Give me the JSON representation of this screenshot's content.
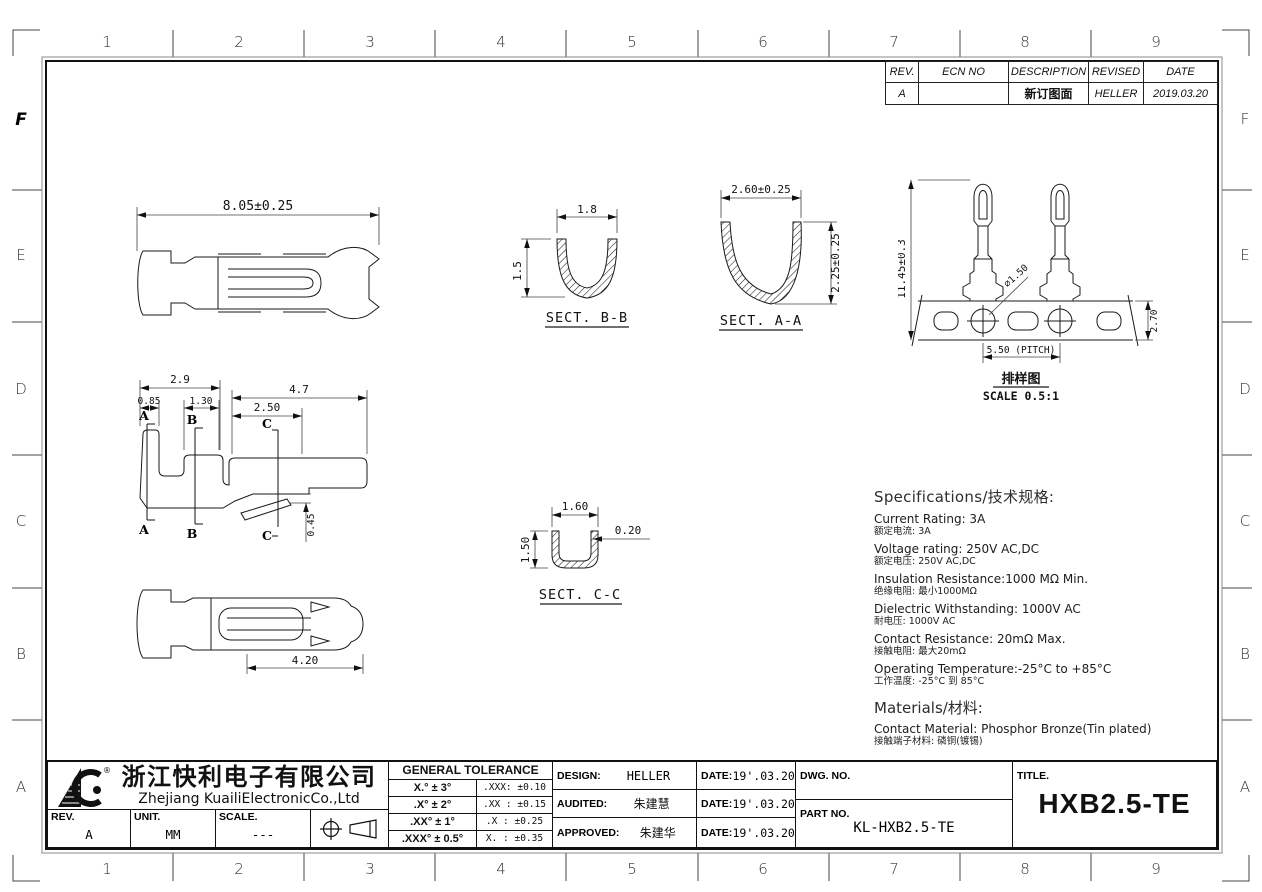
{
  "sheet": {
    "zones": {
      "cols": [
        "1",
        "2",
        "3",
        "4",
        "5",
        "6",
        "7",
        "8",
        "9"
      ],
      "rows": [
        "F",
        "E",
        "D",
        "C",
        "B",
        "A"
      ]
    }
  },
  "revision": {
    "h_rev": "REV.",
    "h_ecn": "ECN NO",
    "h_desc": "DESCRIPTION",
    "h_revised": "REVISED",
    "h_date": "DATE",
    "r_rev": "A",
    "r_ecn": "",
    "r_desc": "新订图面",
    "r_revised": "HELLER",
    "r_date": "2019.03.20"
  },
  "dims": {
    "side_top_length": "8.05±0.25",
    "bb_width": "1.8",
    "bb_height": "1.5",
    "bb_label": "SECT. B-B",
    "aa_width": "2.60±0.25",
    "aa_height": "2.25±0.25",
    "aa_label": "SECT. A-A",
    "strip_height": "11.45±0.3",
    "strip_hole": "⌀1.50",
    "strip_pitch": "5.50 (PITCH)",
    "strip_thk": "2.70",
    "strip_caption": "排样图",
    "strip_scale": "SCALE 0.5:1",
    "p_29": "2.9",
    "p_085": "0.85",
    "p_130": "1.30",
    "p_47": "4.7",
    "p_250": "2.50",
    "p_045": "0.45",
    "sec_a": "A",
    "sec_b": "B",
    "sec_c": "C",
    "cc_width": "1.60",
    "cc_height": "1.50",
    "cc_thk": "0.20",
    "cc_label": "SECT. C-C",
    "bottom_length": "4.20"
  },
  "specs": {
    "heading": "Specifications/技术规格:",
    "items": [
      {
        "en": "Current Rating: 3A",
        "zh": "额定电流: 3A"
      },
      {
        "en": "Voltage rating: 250V AC,DC",
        "zh": "额定电压: 250V AC,DC"
      },
      {
        "en": "Insulation Resistance:1000 MΩ Min.",
        "zh": "绝缘电阻: 最小1000MΩ"
      },
      {
        "en": "Dielectric Withstanding: 1000V AC",
        "zh": "耐电压: 1000V AC"
      },
      {
        "en": "Contact Resistance: 20mΩ Max.",
        "zh": "接触电阻: 最大20mΩ"
      },
      {
        "en": "Operating Temperature:-25°C to +85°C",
        "zh": "工作温度: -25°C 到 85°C"
      }
    ],
    "materials_heading": "Materials/材料:",
    "materials_en": "Contact Material: Phosphor Bronze(Tin plated)",
    "materials_zh": "接触端子材料: 磷铜(镀锡)"
  },
  "titleblock": {
    "logo_r": "®",
    "company_cn": "浙江快利电子有限公司",
    "company_en": "Zhejiang KuailiElectronicCo.,Ltd",
    "rev_label": "REV.",
    "rev_value": "A",
    "unit_label": "UNIT.",
    "unit_value": "MM",
    "scale_label": "SCALE.",
    "scale_value": "---",
    "tolerance": {
      "header": "GENERAL TOLERANCE",
      "rows": [
        {
          "left": "X.° ± 3°",
          "right": ".XXX: ±0.10"
        },
        {
          "left": ".X° ± 2°",
          "right": ".XX : ±0.15"
        },
        {
          "left": ".XX° ± 1°",
          "right": ".X : ±0.25"
        },
        {
          "left": ".XXX° ± 0.5°",
          "right": "X. : ±0.35"
        }
      ]
    },
    "date_label": "DATE:",
    "signoff": [
      {
        "role": "DESIGN:",
        "name": "HELLER",
        "date": "19'.03.20"
      },
      {
        "role": "AUDITED:",
        "name": "朱建慧",
        "date": "19'.03.20"
      },
      {
        "role": "APPROVED:",
        "name": "朱建华",
        "date": "19'.03.20"
      }
    ],
    "dwg_no_label": "DWG. NO.",
    "dwg_no_value": "",
    "part_no_label": "PART NO.",
    "part_no_value": "KL-HXB2.5-TE",
    "title_label": "TITLE.",
    "title_value": "HXB2.5-TE"
  }
}
